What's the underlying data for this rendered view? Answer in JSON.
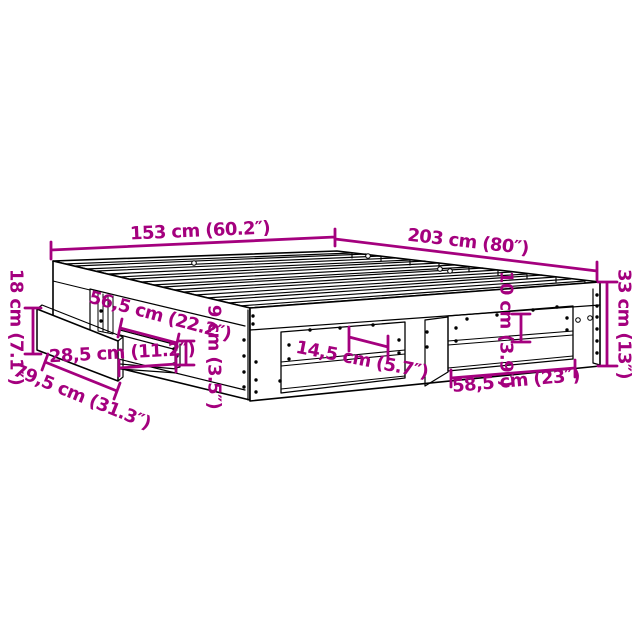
{
  "page": {
    "background": "#ffffff"
  },
  "diagram": {
    "type": "bed-frame-dimension-diagram",
    "accent_color": "#A4007E",
    "line_color": "#000000",
    "dimensions": {
      "bed_width": "153 cm (60.2″)",
      "bed_length": "203 cm (80″)",
      "frame_height": "33 cm (13″)",
      "drawer_front_height": "18 cm (7.1″)",
      "drawer_front_width": "79,5 cm (31.3″)",
      "drawer_rail_length": "56,5 cm (22.2″)",
      "drawer_rail_inner_length": "28,5 cm (11.2″)",
      "drawer_rail_height": "9 cm (3.5″)",
      "shelf_depth": "14,5 cm (5.7″)",
      "shelf_opening_height": "10 cm (3.9″)",
      "shelf_opening_width": "58,5 cm (23″)"
    }
  }
}
